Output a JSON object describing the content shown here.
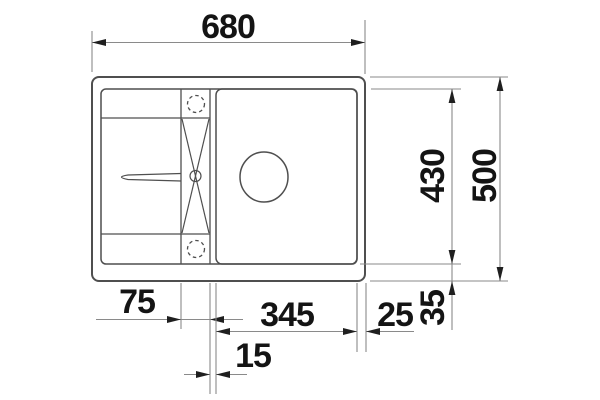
{
  "drawing": {
    "kind": "technical dimension drawing",
    "subject": "kitchen sink top view with drainboard, tap ledge and bowl",
    "background_color": "#ffffff",
    "outline_color": "#4f4f4f",
    "dimension_line_color": "#8a8a8a",
    "arrow_color": "#1f1f1f",
    "text_color": "#141414"
  },
  "dimensions": {
    "overall_width": "680",
    "overall_depth": "500",
    "bowl_depth": "430",
    "tap_ledge_width": "75",
    "bowl_width": "345",
    "right_rim": "25",
    "ledge_bowl_gap": "15",
    "bottom_rim": "35"
  }
}
